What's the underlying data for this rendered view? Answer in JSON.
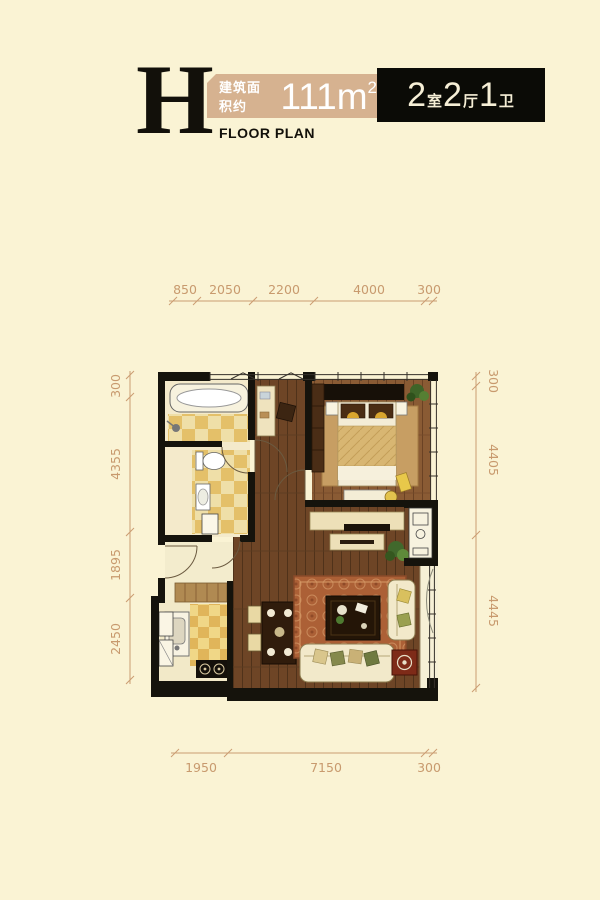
{
  "header": {
    "letter": "H",
    "subtitle": "FLOOR PLAN",
    "area_label": "建筑面积约",
    "area_value": "111m",
    "area_sup": "2",
    "layout": [
      {
        "num": "2",
        "unit": "室"
      },
      {
        "num": "2",
        "unit": "厅"
      },
      {
        "num": "1",
        "unit": "卫"
      }
    ]
  },
  "dimensions": {
    "top": [
      "850",
      "2050",
      "2200",
      "4000",
      "300"
    ],
    "bottom": [
      "1950",
      "7150",
      "300"
    ],
    "left": [
      "300",
      "4355",
      "1895",
      "2450"
    ],
    "right": [
      "300",
      "4405",
      "4445"
    ]
  },
  "colors": {
    "background": "#FAF3D4",
    "dimension": "#C89A6E",
    "area_box": "#D6B290",
    "layout_box": "#0B0B06",
    "wall": "#15130C",
    "wood_floor": "#6E4526",
    "bedroom_floor": "#8A5B34",
    "tile_yellow": "#EFD385",
    "rug": "#AC6036"
  }
}
